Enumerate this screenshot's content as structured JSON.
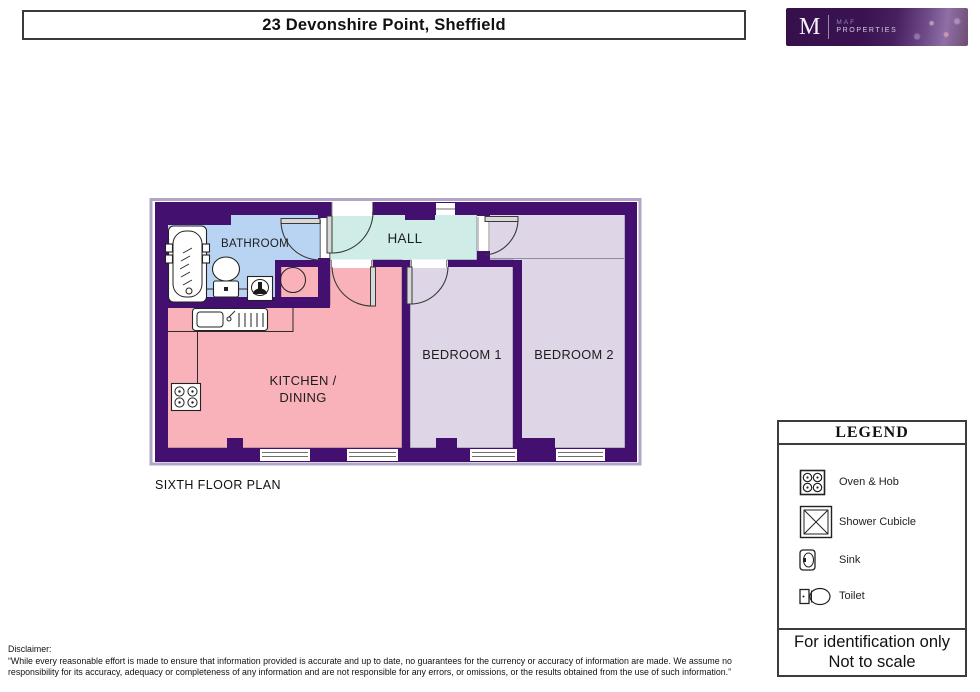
{
  "header": {
    "title": "23 Devonshire Point, Sheffield"
  },
  "logo": {
    "monogram": "M",
    "brand_top": "MAF",
    "brand_bottom": "PROPERTIES"
  },
  "floorplan": {
    "caption": "SIXTH FLOOR PLAN",
    "rooms": {
      "bathroom": "BATHROOM",
      "hall": "HALL",
      "kitchen_line1": "KITCHEN /",
      "kitchen_line2": "DINING",
      "bedroom1": "BEDROOM 1",
      "bedroom2": "BEDROOM 2"
    },
    "colors": {
      "wall": "#431070",
      "bathroom": "#b9d4f2",
      "hall": "#cfece6",
      "kitchen": "#f9b1ba",
      "bedroom": "#ded6e6",
      "plan_outline": "#b2a6c6"
    }
  },
  "legend": {
    "title": "LEGEND",
    "items": [
      {
        "icon": "oven-hob-icon",
        "label": "Oven & Hob"
      },
      {
        "icon": "shower-cubicle-icon",
        "label": "Shower Cubicle"
      },
      {
        "icon": "sink-icon",
        "label": "Sink"
      },
      {
        "icon": "toilet-icon",
        "label": "Toilet"
      }
    ],
    "footer_line1": "For identification only",
    "footer_line2": "Not to scale"
  },
  "disclaimer": {
    "label": "Disclaimer:",
    "text": "“While every reasonable effort is made to ensure that information provided is accurate and up to date, no guarantees for the currency or accuracy of information are made. We assume no responsibility for its accuracy, adequacy or completeness of any information and are not responsible for any errors, or omissions, or the results obtained from the use of such information.”"
  }
}
